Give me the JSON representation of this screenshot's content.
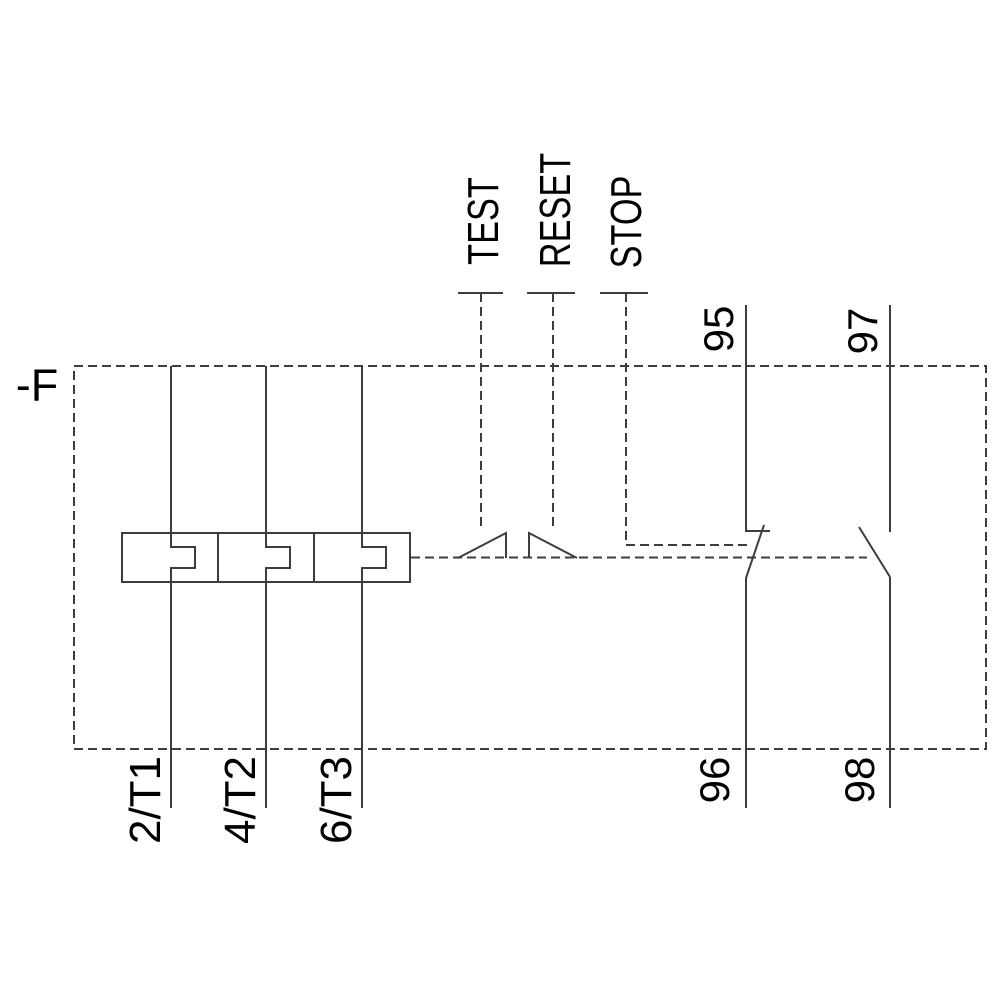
{
  "schematic": {
    "kind": "overload-relay-circuit-diagram",
    "device_label": "-F",
    "actuators": {
      "test": "TEST",
      "reset": "RESET",
      "stop": "STOP"
    },
    "aux_contacts": {
      "nc_top": "95",
      "nc_bottom": "96",
      "no_top": "97",
      "no_bottom": "98"
    },
    "main_terminals": {
      "phase1": "2/T1",
      "phase2": "4/T2",
      "phase3": "6/T3"
    },
    "colors": {
      "background": "#ffffff",
      "line": "#3d3d3d",
      "text": "#000000"
    }
  }
}
